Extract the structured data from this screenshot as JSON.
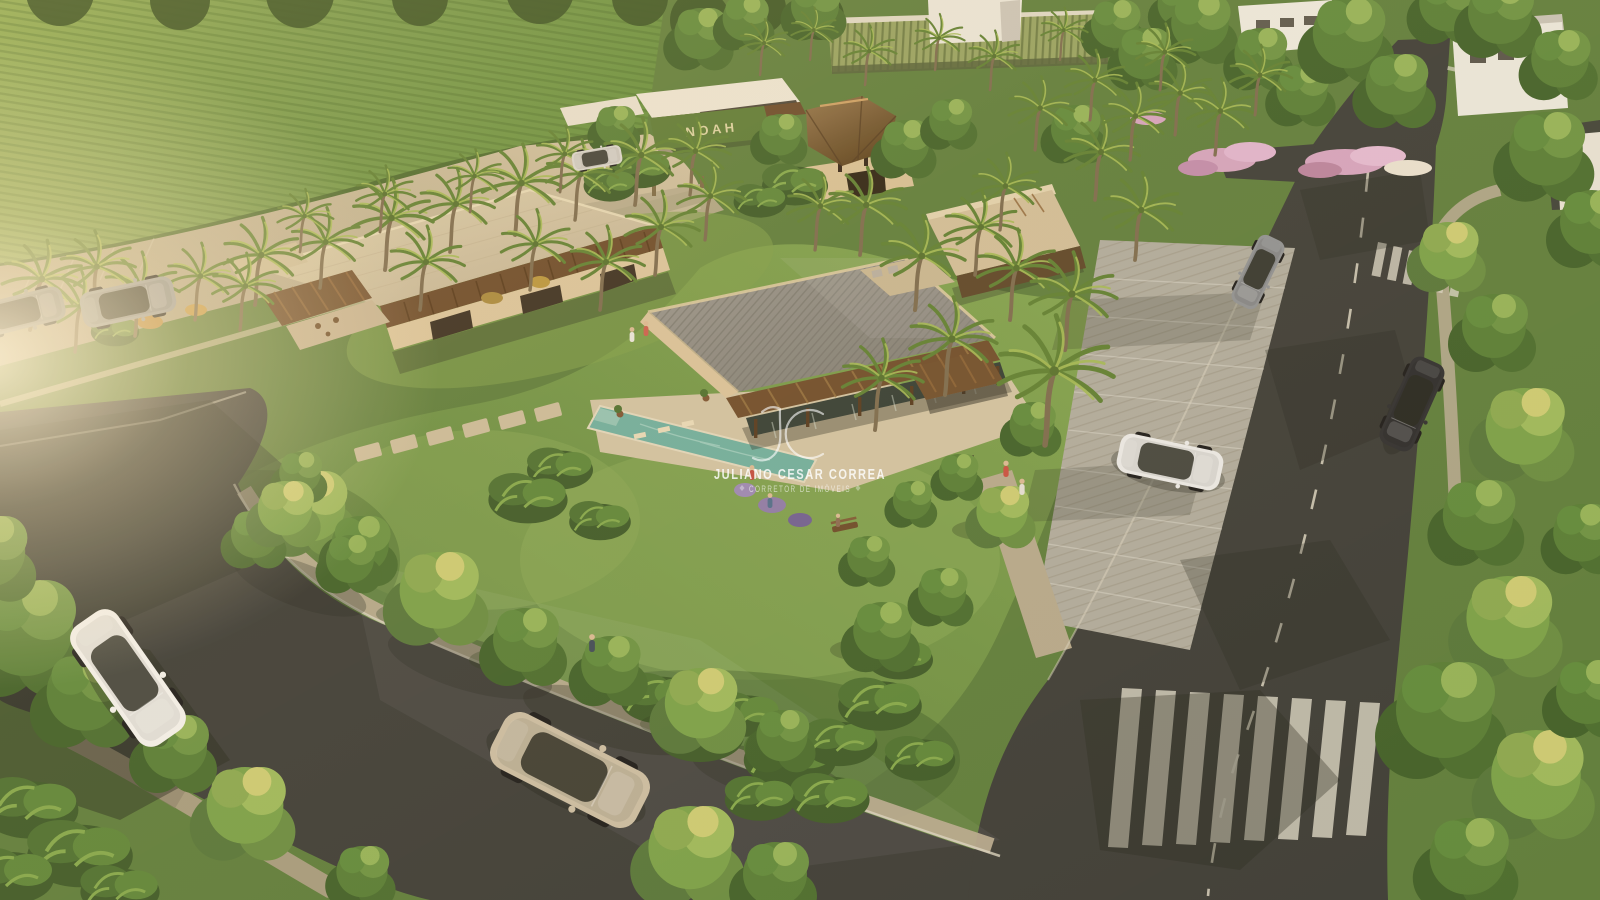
{
  "watermark": {
    "monogram": "JC",
    "name": "JULIANO CESAR CORREA",
    "title": "CORRETOR DE IMÓVEIS",
    "color": "#ffffff"
  },
  "signage": {
    "entrance_sign": "NOAH",
    "sign_color": "#d9d0a0"
  },
  "palette": {
    "asphalt": "#3b3c38",
    "light_road": "#b7ab8e",
    "lawn": "#6f9246",
    "field": "#78994a",
    "pool": "#6fae9e",
    "building_wall": "#d9c49c",
    "metal_roof": "#8e8b82",
    "big_roof": "#cfc2a2",
    "wood": "#6d4c2c",
    "paver": "#b3a78f",
    "curb": "#d9d3c2",
    "crosswalk": "#d6d2c4",
    "flowers_pink": "#d3a4bf",
    "glass": "#333d35",
    "sun_haze": "#fff3d8"
  }
}
